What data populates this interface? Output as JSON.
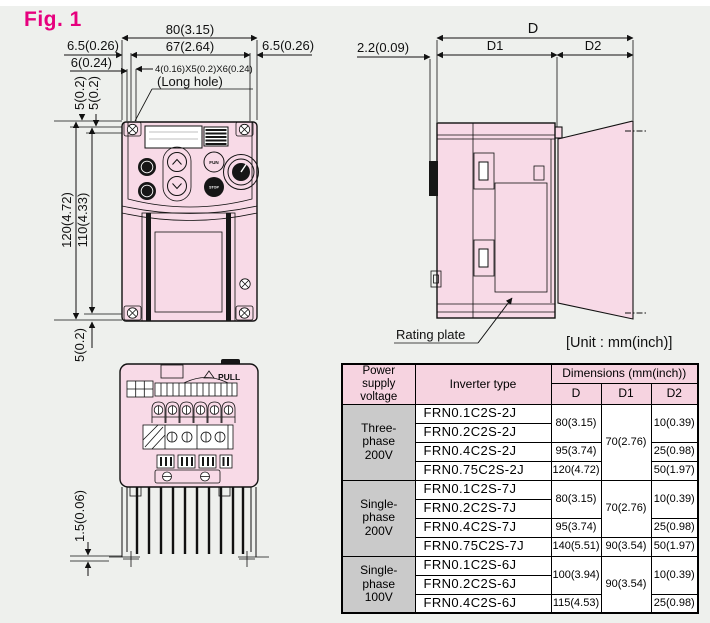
{
  "figure_label": "Fig. 1",
  "unit_note": "[Unit : mm(inch)]",
  "front_view": {
    "dim_width_total": "80(3.15)",
    "dim_width_holes": "67(2.64)",
    "dim_edge_left": "6.5(0.26)",
    "dim_edge_right": "6.5(0.26)",
    "dim_edge_6": "6(0.24)",
    "dim_long_hole": "4(0.16)X5(0.2)X6(0.24)",
    "long_hole_note": "(Long hole)",
    "dim_top_offset_a": "5(0.2)",
    "dim_top_offset_b": "5(0.2)",
    "dim_height_total": "120(4.72)",
    "dim_height_holes": "110(4.33)",
    "dim_bottom_offset": "5(0.2)",
    "keypad": {
      "fun": "FUN",
      "stop": "STOP"
    }
  },
  "side_view": {
    "dim_depth_total": "D",
    "dim_depth_front": "D1",
    "dim_depth_fin": "D2",
    "dim_hook": "2.2(0.09)",
    "rating_plate_label": "Rating plate"
  },
  "bottom_view": {
    "pull_label": "PULL",
    "dim_fin_base": "1.5(0.06)"
  },
  "table": {
    "header": {
      "power_supply": "Power supply\nvoltage",
      "inverter_type": "Inverter type",
      "dimensions": "Dimensions (mm(inch))",
      "d": "D",
      "d1": "D1",
      "d2": "D2"
    },
    "groups": [
      {
        "voltage": "Three-phase\n200V",
        "types": [
          "FRN0.1C2S-2J",
          "FRN0.2C2S-2J",
          "FRN0.4C2S-2J",
          "FRN0.75C2S-2J"
        ],
        "d": [
          "80(3.15)",
          "95(3.74)",
          "120(4.72)"
        ],
        "d1": [
          "70(2.76)"
        ],
        "d2": [
          "10(0.39)",
          "25(0.98)",
          "50(1.97)"
        ]
      },
      {
        "voltage": "Single-phase\n200V",
        "types": [
          "FRN0.1C2S-7J",
          "FRN0.2C2S-7J",
          "FRN0.4C2S-7J",
          "FRN0.75C2S-7J"
        ],
        "d": [
          "80(3.15)",
          "95(3.74)",
          "140(5.51)"
        ],
        "d1": [
          "70(2.76)",
          "90(3.54)"
        ],
        "d2": [
          "10(0.39)",
          "25(0.98)",
          "50(1.97)"
        ]
      },
      {
        "voltage": "Single-phase\n100V",
        "types": [
          "FRN0.1C2S-6J",
          "FRN0.2C2S-6J",
          "FRN0.4C2S-6J"
        ],
        "d": [
          "100(3.94)",
          "115(4.53)"
        ],
        "d1": [
          "90(3.54)"
        ],
        "d2": [
          "10(0.39)",
          "25(0.98)"
        ]
      }
    ]
  },
  "colors": {
    "accent": "#e6007e",
    "body_pink": "#f8dae7",
    "header_pink": "#f6d3e0",
    "group_gray": "#cacaca"
  }
}
